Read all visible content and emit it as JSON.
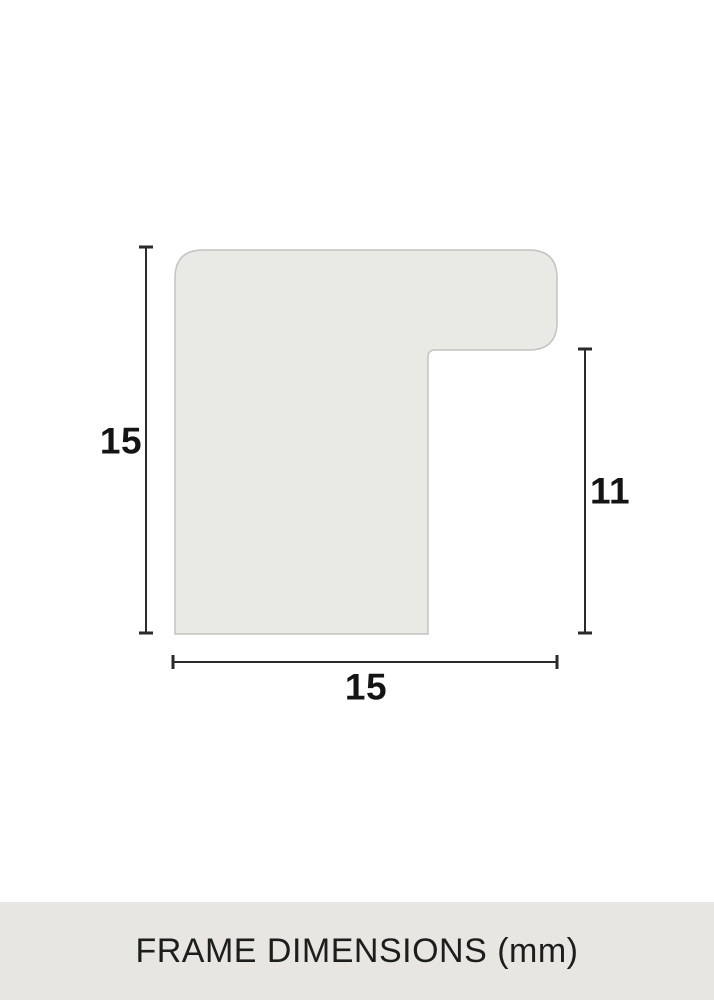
{
  "diagram": {
    "description": "frame-moulding-profile-cross-section",
    "labels": {
      "height": "15",
      "rabbet_height": "11",
      "width": "15"
    },
    "values_mm": {
      "height": 15,
      "rabbet_height": 11,
      "width": 15
    },
    "colors": {
      "background": "#ffffff",
      "shape_fill": "#e9e9e5",
      "shape_stroke": "#c3c3bf",
      "dimension_line": "#2b2b2b",
      "label_text": "#141414",
      "footer_background": "#e7e6e2",
      "footer_text": "#1d1d1b"
    }
  },
  "footer": {
    "title": "FRAME DIMENSIONS (mm)"
  }
}
